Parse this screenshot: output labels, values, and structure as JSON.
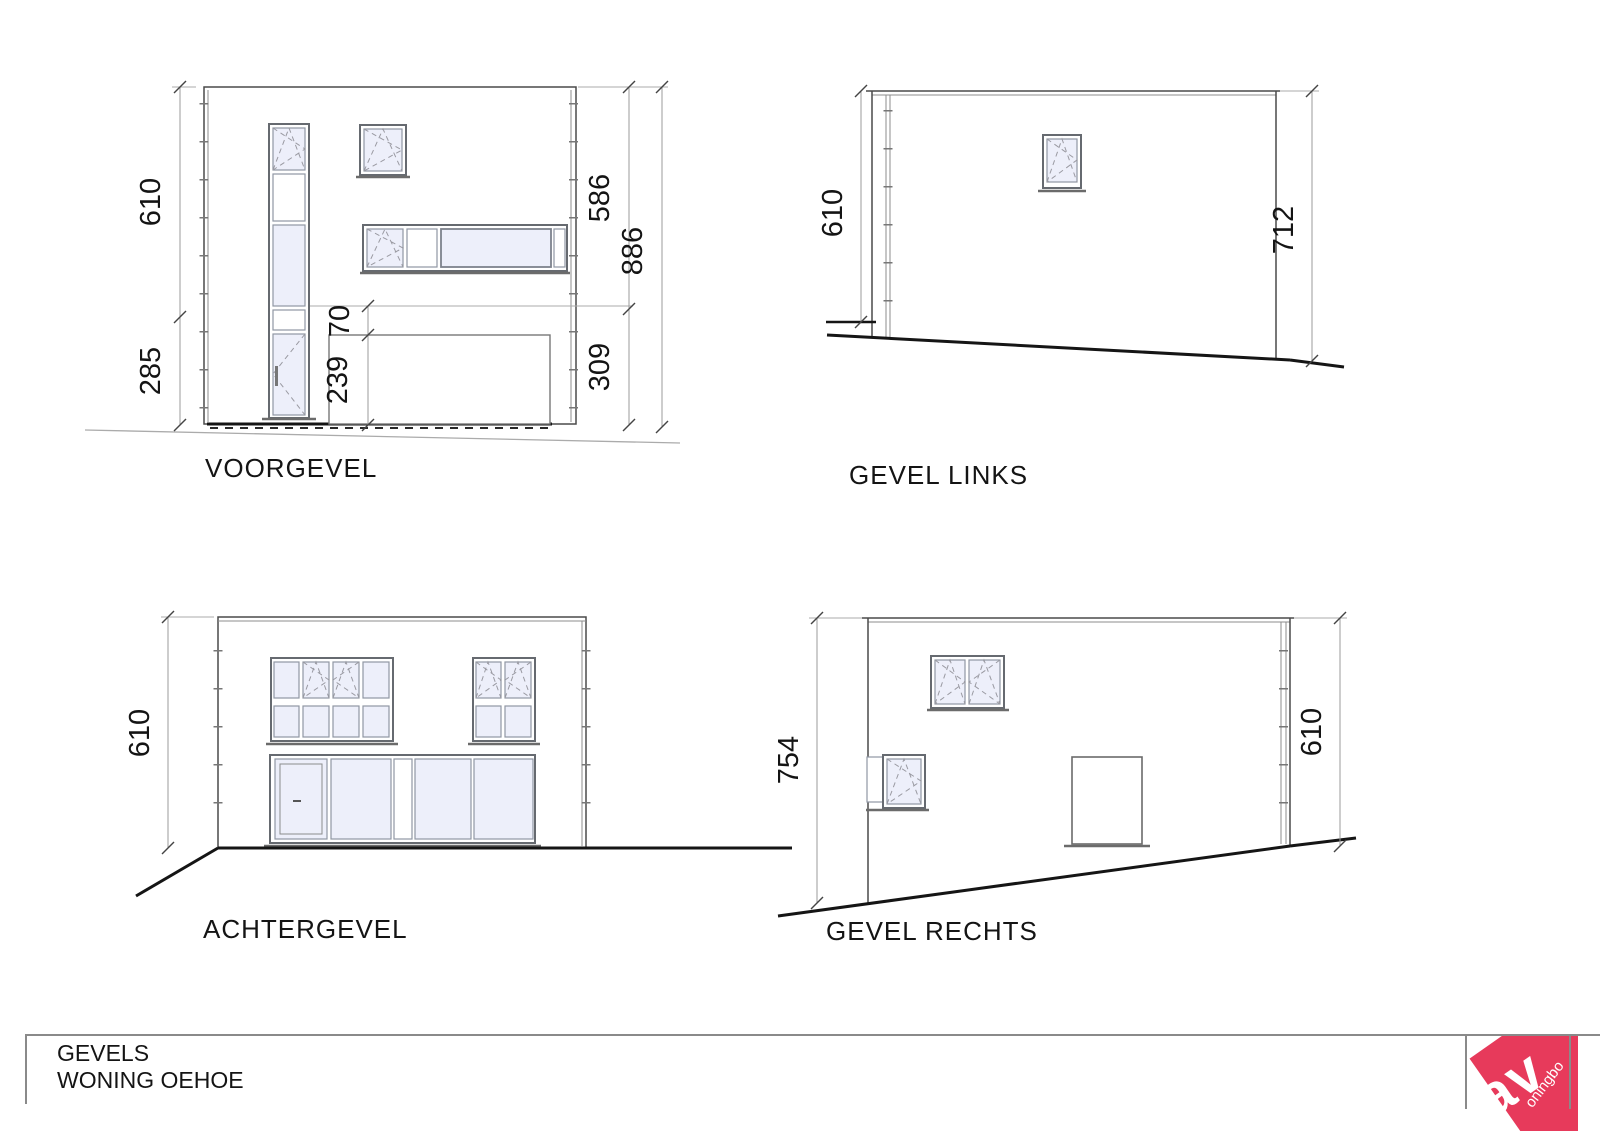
{
  "title_block": {
    "line1": "GEVELS",
    "line2": "WONING OEHOE"
  },
  "logo": {
    "big_text": "av",
    "small_text": "oningbo",
    "color": "#e73a5b"
  },
  "elevations": {
    "voorgevel": {
      "title": "VOORGEVEL",
      "dims": {
        "left_upper": "610",
        "left_lower": "285",
        "right_upper": "586",
        "right_lower": "309",
        "right_total": "886",
        "garage_offset": "70",
        "garage_height": "239"
      }
    },
    "gevel_links": {
      "title": "GEVEL LINKS",
      "dims": {
        "left": "610",
        "right": "712"
      }
    },
    "achtergevel": {
      "title": "ACHTERGEVEL",
      "dims": {
        "left": "610"
      }
    },
    "gevel_rechts": {
      "title": "GEVEL RECHTS",
      "dims": {
        "left": "754",
        "right": "610"
      }
    }
  }
}
